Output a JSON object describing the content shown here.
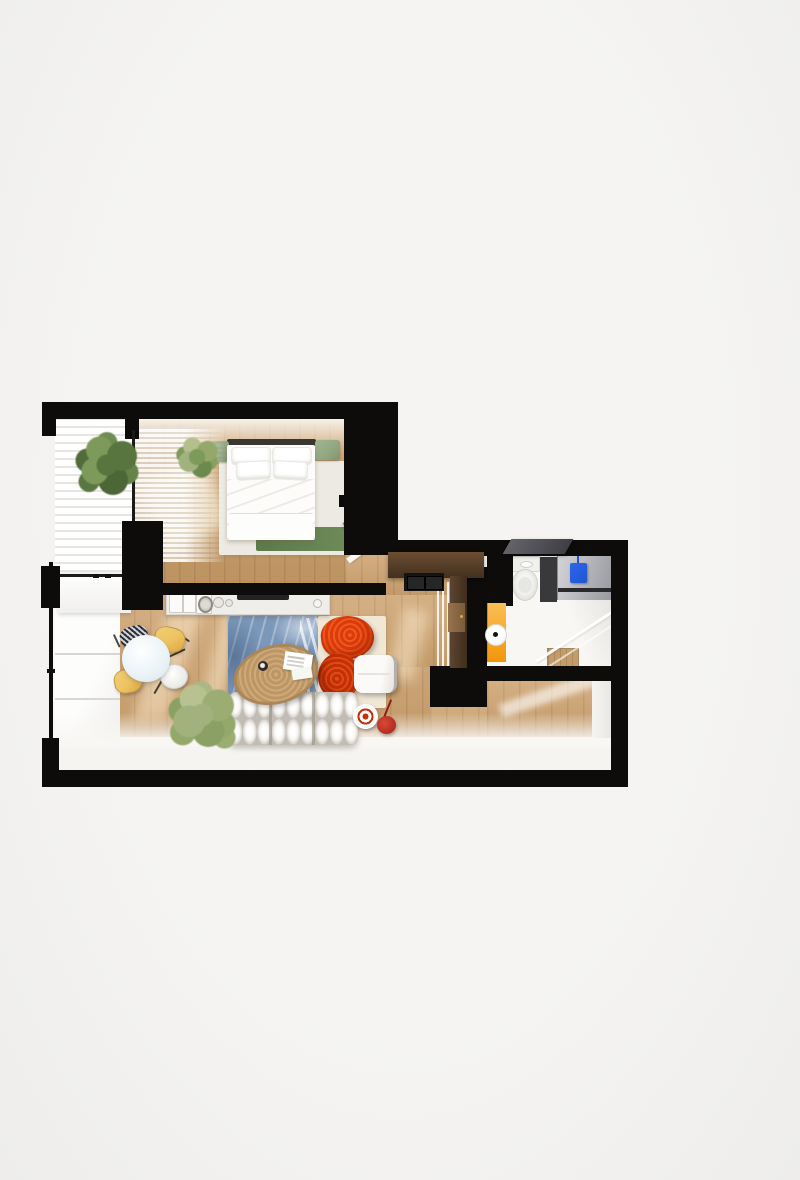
{
  "scene": {
    "type": "3d-floor-plan-render",
    "view": "top-down",
    "subject": "one-bedroom apartment with open living room and kitchen, hallway, bathroom and balcony",
    "background_color": "#f2f1ef"
  },
  "palette": {
    "bg": "#f2f1ef",
    "wall": "#0d0c0a",
    "wood": "#cda26f",
    "bedroom-wood": "#c89b66",
    "wardrobe": "#43301f",
    "wardrobe-door": "#97734e",
    "shoe-cab": "#141414",
    "floor-white": "#f6f5f2",
    "blind-line": "#e7e5e0",
    "bed": "#fdfcfa",
    "headboard": "#3a3733",
    "sage": "#91a681",
    "rug-green": "#5c7a4a",
    "rug-white": "#eceae3",
    "rug-blue": "#7b97ba",
    "rug-cream": "#f0e7d5",
    "jute": "#bc9765",
    "jute-dark": "#aa875a",
    "red": "#dc3c0c",
    "red-deep": "#c23107",
    "ottoman": "#f3f1ed",
    "sofa": "#f6f5f2",
    "sofa-shade": "#d7d3cb",
    "yellow": "#edc261",
    "stripe-dark": "#2c2f35",
    "table": "#e9f2f7",
    "counter": "#f0eeea",
    "cooktop": "#232323",
    "plant": "#7d9a5a",
    "plant-dark": "#58743f",
    "plant-light": "#a2b27f",
    "cab-yellow": "#f1960a",
    "towel": "#1e55d5",
    "appliance": "#aeafb5",
    "panel": "#39383a",
    "shelf": "#3e3e44",
    "tray": "#c29d6b"
  },
  "rooms": [
    {
      "name": "bedroom",
      "floor": "oak",
      "items": [
        "double-bed",
        "pillows",
        "headboard-cushions",
        "white-area-rug",
        "green-runner-rug",
        "sheer-curtain",
        "potted-plant",
        "open-door"
      ]
    },
    {
      "name": "bedroom-balcony",
      "floor": "white",
      "items": [
        "horizontal-blinds",
        "potted-plant",
        "window-sill-radiator"
      ]
    },
    {
      "name": "living-room-kitchen",
      "floor": "oak",
      "items": [
        "kitchen-counter",
        "cooktop",
        "sink",
        "round-dining-table",
        "dining-chairs",
        "potted-plant",
        "blue-patterned-rug",
        "jute-coffee-table",
        "magazines",
        "coffee-cup",
        "red-armchairs",
        "white-ottoman",
        "tufted-white-sofa",
        "floor-lamps"
      ]
    },
    {
      "name": "hallway",
      "floor": "oak",
      "items": [
        "wardrobe",
        "shoe-cabinet",
        "mirror-strip"
      ]
    },
    {
      "name": "bathroom",
      "floor": "white",
      "items": [
        "toilet",
        "laundry-column",
        "countertop",
        "blue-towel",
        "yellow-cabinet",
        "toilet-paper-roll",
        "glass-shower",
        "wall-shelf"
      ]
    },
    {
      "name": "entry-hall",
      "floor": "oak",
      "items": []
    },
    {
      "name": "living-balcony",
      "floor": "white",
      "items": [
        "glass-panels"
      ]
    }
  ]
}
